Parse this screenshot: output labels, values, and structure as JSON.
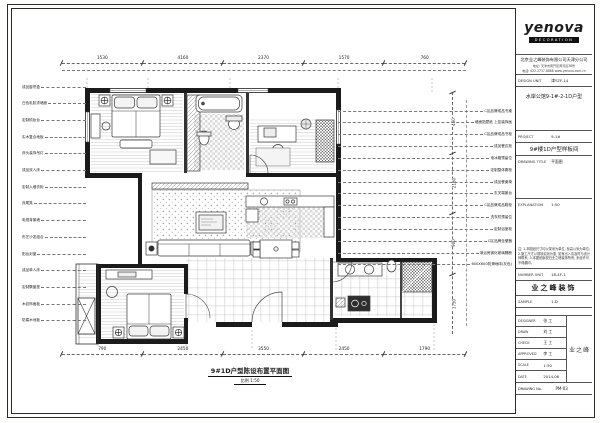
{
  "caption": {
    "title": "9#1D户型陈设布置平面图",
    "scale": "比例 1:50"
  },
  "dimensions": {
    "top": [
      "1530",
      "4160",
      "2370",
      "1570",
      "760"
    ],
    "bottom": [
      "790",
      "2450",
      "3550",
      "2450",
      "1790"
    ],
    "right": [
      "460",
      "2160",
      "900",
      "1750"
    ]
  },
  "left_labels": [
    "成品窗帘盒",
    "白色乳胶漆墙面",
    "定制梳妆台",
    "实木复合地板",
    "床头装饰吊灯",
    "成品双人床",
    "定制入墙衣柜",
    "床尾凳",
    "电视背景墙",
    "布艺沙发组合",
    "阳台封窗",
    "成品单人床",
    "定制飘窗垫",
    "木纹饰面板",
    "防腐木地板"
  ],
  "right_labels": [
    "C区品牌成品书桌",
    "墙面贴壁纸 上挂装饰画",
    "C区品牌成品书柜",
    "成品餐边柜",
    "电冰箱预留位",
    "定制整体橱柜",
    "成品餐桌椅",
    "玄关端景台",
    "C区品牌成品鞋柜",
    "洗衣机预留位",
    "定制浴室柜",
    "C区品牌坐便器",
    "淋浴房钢化玻璃隔断",
    "600X600防滑地砖(灰色)"
  ],
  "title_block": {
    "logo": "yenova",
    "logo_sub": "DECORATION",
    "company": "北京业之峰装饰有限公司天津分公司",
    "address1": "地址: 天津市南开区黄河道38号",
    "address2": "电话: 022-2737-8888  www.yenova.com.cn",
    "design_unit_label": "DESIGN UNIT",
    "design_unit_value": "津YZF-14",
    "project_name_top": "水岸公馆9-1#-2-1D户型",
    "project_label": "PROJECT",
    "project_value": "9-1#",
    "project_cn": "9#楼1D户型样板间",
    "drawing_title_label": "DRAWING TITLE",
    "drawing_title_value": "平面图",
    "explanation_label": "EXPLANATION",
    "explanation_value": "1:50",
    "note": "注: 1.本图纸尺寸均以毫米为单位, 标高以米为单位; 2.施工尺寸以现场实测为准, 如有出入请及时与设计师联系; 3.本图纸版权归业之峰装饰所有, 未经许可不得翻印。",
    "number_label": "NUMBER UNIT",
    "number_value": "18-4F-1",
    "brand": "业之峰装饰",
    "sample_label": "SAMPLE",
    "sample_value": "1-D",
    "rows": [
      {
        "label": "DESIGNER",
        "value": "张 工"
      },
      {
        "label": "DRAW",
        "value": "刘 工"
      },
      {
        "label": "CHECK",
        "value": "王 工"
      },
      {
        "label": "APPROVED",
        "value": "李 工"
      },
      {
        "label": "SCALE",
        "value": "1:50"
      },
      {
        "label": "DATE",
        "value": "2014.06"
      }
    ],
    "stamp": "业之峰",
    "drawing_no_label": "DRAWING No.",
    "drawing_no_value": "PM-03"
  }
}
